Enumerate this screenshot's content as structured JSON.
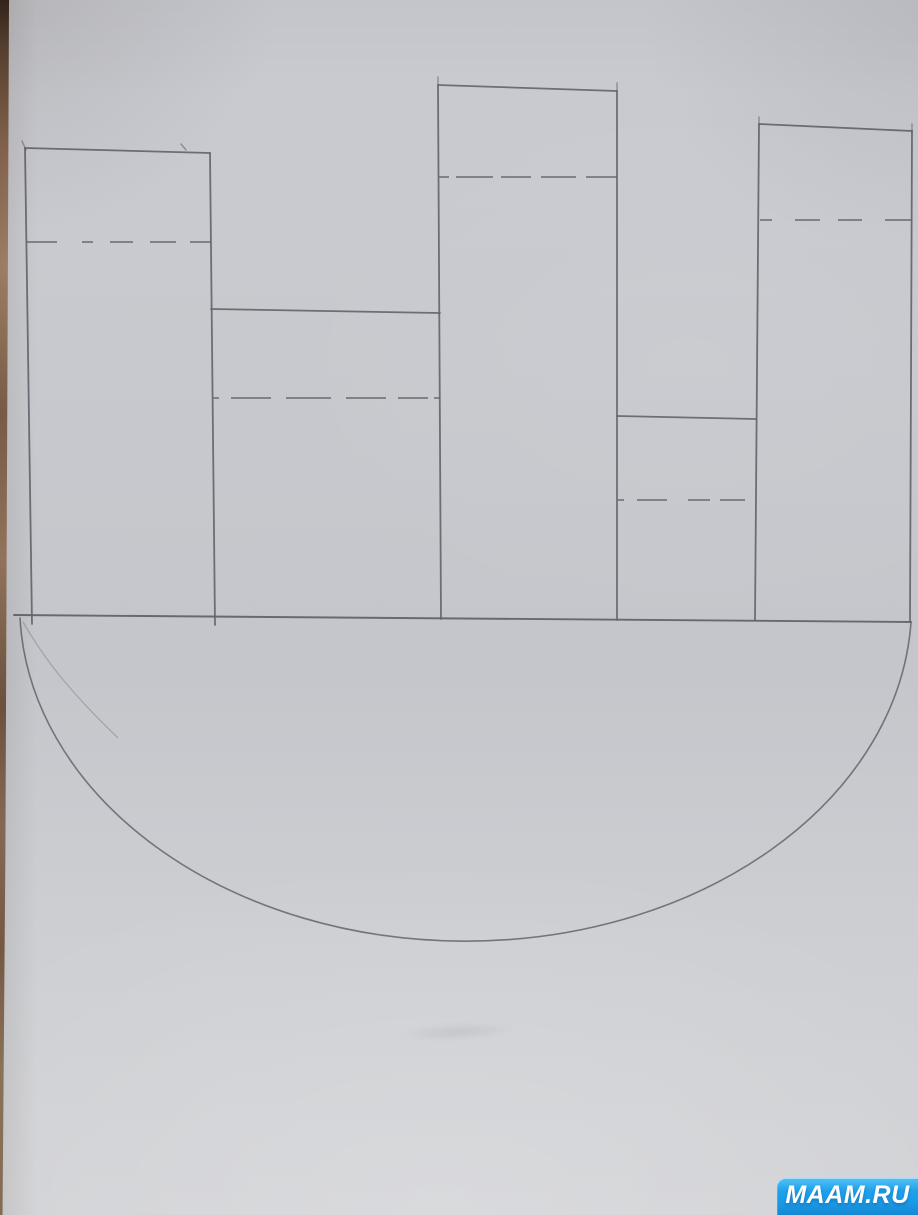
{
  "watermark": {
    "label": "MAAM.RU",
    "bg_color": "#1ea2ec",
    "bg_color_light": "#55c0f5",
    "text_color": "#ffffff"
  },
  "scene": {
    "description": "Photo of a hand-drawn pencil paper-craft template: a semicircular boat hull under a baseline with five rectangular funnel flaps, each crossed by a dashed fold line",
    "paper_color": "#c8c9ce",
    "pencil_color": "#63646c",
    "table_edge_color": "#8d6a52"
  },
  "drawing": {
    "baseline": {
      "x1": 14,
      "y1": 615,
      "x2": 911,
      "y2": 622
    },
    "hull_arc": {
      "x1": 20,
      "y1": 618,
      "x2": 911,
      "y2": 622,
      "rx": 446,
      "ry": 337
    },
    "arc_ghost_path": "M 23 622 C 42 655 66 688 118 738",
    "verticals": [
      [
        25,
        148,
        32,
        624
      ],
      [
        210,
        153,
        215,
        625
      ],
      [
        438,
        85,
        441,
        619
      ],
      [
        617,
        91,
        617,
        620
      ],
      [
        759,
        124,
        755,
        620
      ],
      [
        912,
        131,
        910,
        621
      ]
    ],
    "tops": [
      [
        25,
        148,
        210,
        153
      ],
      [
        211,
        309,
        440,
        313
      ],
      [
        438,
        85,
        617,
        91
      ],
      [
        617,
        416,
        756,
        419
      ],
      [
        759,
        124,
        912,
        131
      ]
    ],
    "fold_lines": [
      {
        "x1": 27,
        "x2": 211,
        "y": 242,
        "dash": "30 25 11 17 23 17 26 14 21 20"
      },
      {
        "x1": 213,
        "x2": 440,
        "y": 398,
        "dash": "6 12 40 15 45 15 40 12 30"
      },
      {
        "x1": 439,
        "x2": 617,
        "y": 177,
        "dash": "10 7 37 8 30 10 35 10 32"
      },
      {
        "x1": 618,
        "x2": 755,
        "y": 500,
        "dash": "6 13 30 21 22 10 25 15"
      },
      {
        "x1": 760,
        "x2": 912,
        "y": 220,
        "dash": "12 23 25 18 24 23 27"
      }
    ],
    "overshoot_ticks": [
      [
        22,
        141,
        26,
        150
      ],
      [
        181,
        144,
        186,
        150
      ],
      [
        438,
        77,
        438,
        86
      ],
      [
        617,
        83,
        617,
        91
      ],
      [
        759,
        117,
        759,
        125
      ],
      [
        912,
        124,
        912,
        132
      ]
    ]
  }
}
